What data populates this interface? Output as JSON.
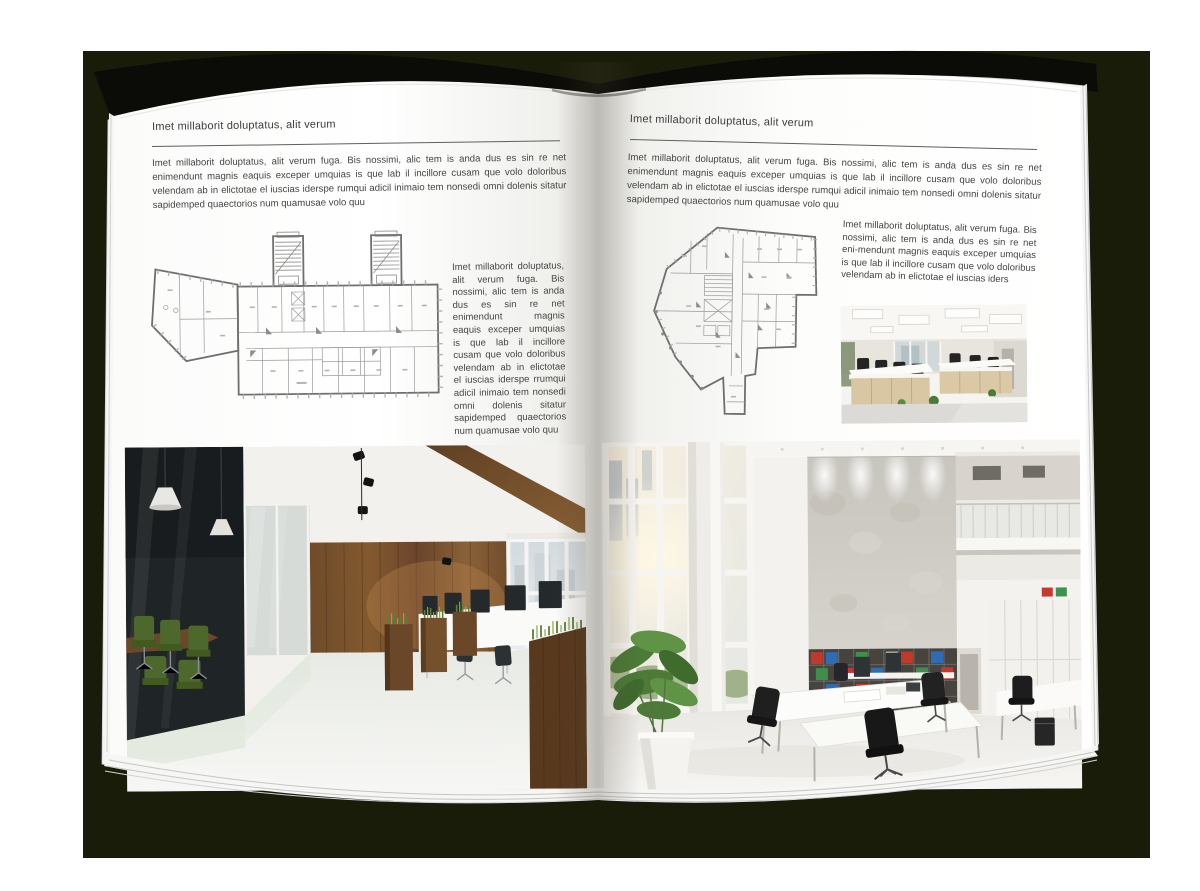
{
  "colors": {
    "backdrop": "#1a1c0a",
    "cover": "#0b0b07",
    "page": "#ffffff",
    "heading_text": "#3c3c3c",
    "body_text": "#454545",
    "wood_accent": "#6e4b29",
    "plant_green": "#4e7a37"
  },
  "left_page": {
    "header": "Imet millaborit doluptatus, alit verum",
    "intro": "Imet millaborit doluptatus, alit verum fuga. Bis nossimi, alic tem is anda dus es sin re net enimendunt magnis eaquis exceper umquias is que lab il incillore cusam que volo doloribus velendam ab in elictotae el iuscias iderspe rumqui adicil inimaio tem nonsedi omni dolenis sitatur sapidemped quaectorios num quamusae volo quu",
    "side_text": "Imet millaborit doluptatus, alit verum fuga. Bis nossimi, alic tem is anda dus es sin re net enimendunt magnis eaquis exceper umquias is que lab il incillore cusam que volo doloribus velendam ab in elictotae el iuscias iderspe rrumqui adicil inimaio tem nonsedi omni dolenis sitatur sapidemped quaectorios num quamusae volo quu"
  },
  "right_page": {
    "header": "Imet millaborit doluptatus, alit verum",
    "intro": "Imet millaborit doluptatus, alit verum fuga. Bis nossimi, alic tem is anda dus es sin re net enimendunt magnis eaquis exceper umquias is que lab il incillore cusam que volo doloribus velendam ab in elictotae el iuscias iderspe rumqui adicil inimaio tem nonsedi omni dolenis sitatur sapidemped quaectorios num quamusae volo quu",
    "side_text": "Imet millaborit doluptatus, alit verum fuga. Bis nossimi, alic tem is anda dus es sin re net eni-mendunt magnis eaquis exceper umquias is que lab il incillore cusam que volo doloribus velendam ab in elictotae el iuscias iders"
  }
}
